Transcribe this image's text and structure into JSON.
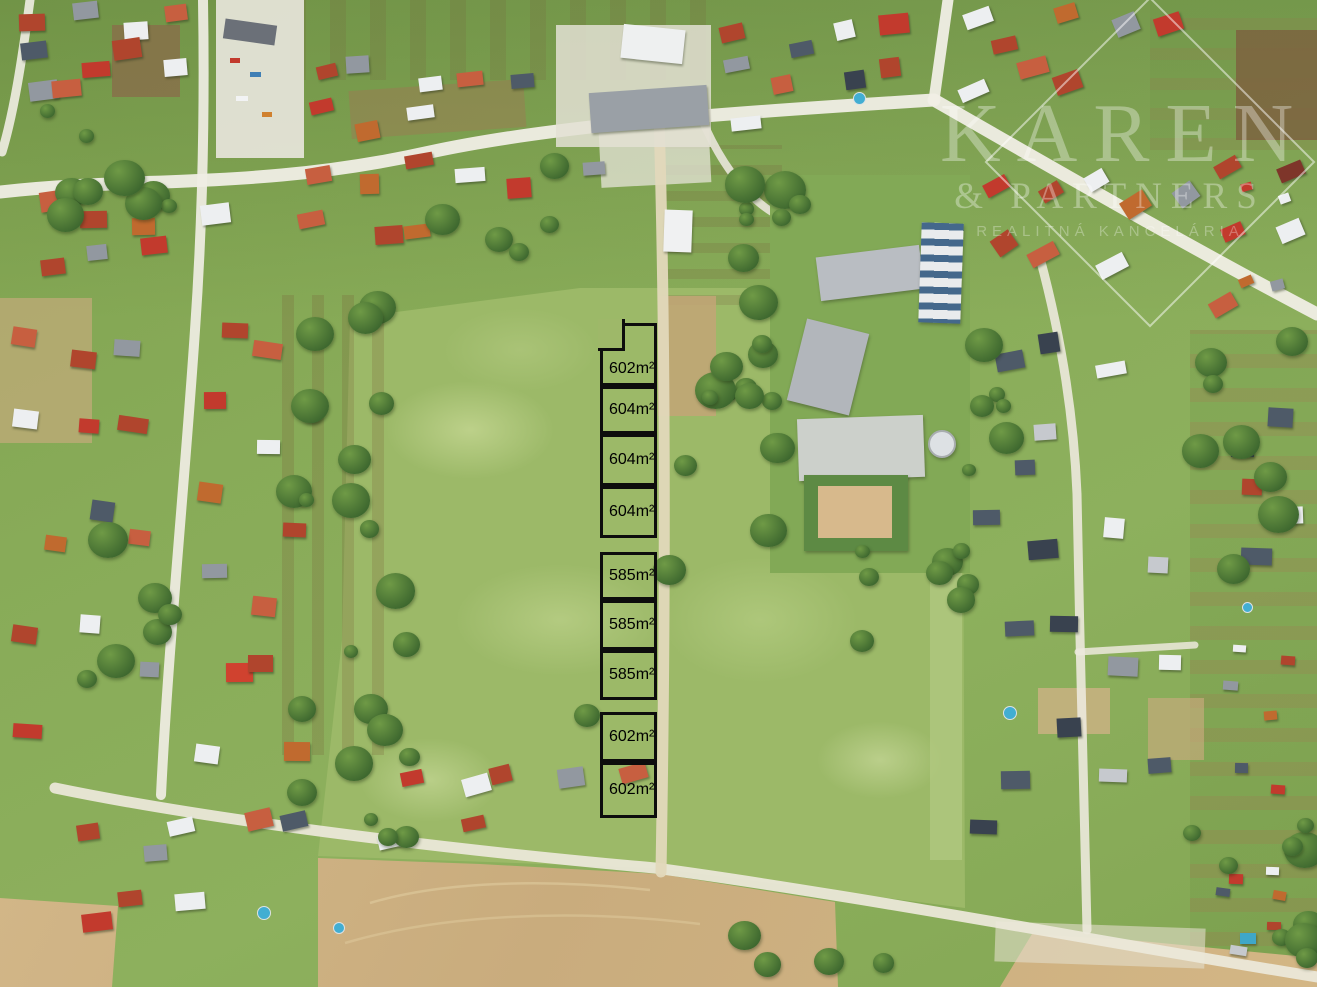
{
  "image": {
    "kind": "aerial-drone-photo",
    "width": 1317,
    "height": 987
  },
  "watermark": {
    "brand": "KAREN",
    "partners": "& PARTNERS",
    "tagline": "REALITNÁ KANCELÁRIA",
    "color": "#ffffff"
  },
  "plot_column": {
    "x": 600,
    "width": 57,
    "outline_color": "#0d0d0d",
    "label_color": "#000000",
    "plots": [
      {
        "label": "602m²",
        "top": 323,
        "height": 63,
        "notch": true
      },
      {
        "label": "604m²",
        "top": 386,
        "height": 48
      },
      {
        "label": "604m²",
        "top": 434,
        "height": 52
      },
      {
        "label": "604m²",
        "top": 486,
        "height": 52
      },
      {
        "label": "585m²",
        "top": 552,
        "height": 48
      },
      {
        "label": "585m²",
        "top": 600,
        "height": 50
      },
      {
        "label": "585m²",
        "top": 650,
        "height": 50
      },
      {
        "label": "602m²",
        "top": 712,
        "height": 50
      },
      {
        "label": "602m²",
        "top": 762,
        "height": 56
      }
    ]
  },
  "palette": {
    "grass": "#87a956",
    "meadow": "#9cb968",
    "road": "#f0eee5",
    "dirt_path": "#e2d8ba",
    "plowed_field": "#cfb284",
    "tree": "#3e682f",
    "plot_line": "#0d0d0d",
    "roof_red": "#b0452d",
    "roof_salmon": "#c75f40",
    "roof_orange": "#c06a2f",
    "roof_bright_red": "#c23a2d",
    "roof_gray": "#9298a0",
    "roof_slate": "#4e5a68",
    "roof_dark_slate": "#39424f",
    "roof_white": "#edeff1"
  },
  "scene": {
    "house_clusters": [
      {
        "name": "top-edge-left",
        "x": 5,
        "y": 2,
        "w": 210,
        "h": 118,
        "n": 10,
        "rot": -6,
        "seed": 11,
        "colors": [
          "#b0452d",
          "#9298a0",
          "#edeff1",
          "#c75f40",
          "#4e5a68",
          "#c23a2d",
          "#b0452d",
          "#edeff1",
          "#9298a0",
          "#c75f40"
        ]
      },
      {
        "name": "top-left-road-south",
        "x": 35,
        "y": 192,
        "w": 200,
        "h": 85,
        "n": 7,
        "rot": -4,
        "seed": 12,
        "colors": [
          "#c75f40",
          "#b0452d",
          "#c06a2f",
          "#edeff1",
          "#b0452d",
          "#9298a0",
          "#c23a2d"
        ]
      },
      {
        "name": "top-mid-north",
        "x": 300,
        "y": 55,
        "w": 250,
        "h": 85,
        "n": 8,
        "rot": -8,
        "seed": 13,
        "colors": [
          "#b0452d",
          "#9298a0",
          "#edeff1",
          "#c75f40",
          "#4e5a68",
          "#c23a2d",
          "#c06a2f",
          "#edeff1"
        ]
      },
      {
        "name": "top-mid-south",
        "x": 295,
        "y": 150,
        "w": 310,
        "h": 110,
        "n": 9,
        "rot": -6,
        "seed": 14,
        "colors": [
          "#c75f40",
          "#c06a2f",
          "#b0452d",
          "#edeff1",
          "#c23a2d",
          "#9298a0",
          "#c75f40",
          "#b0452d",
          "#c06a2f"
        ]
      },
      {
        "name": "top-center",
        "x": 715,
        "y": 15,
        "w": 215,
        "h": 125,
        "n": 9,
        "rot": -10,
        "seed": 15,
        "colors": [
          "#b0452d",
          "#4e5a68",
          "#edeff1",
          "#c23a2d",
          "#9298a0",
          "#c75f40",
          "#39424f",
          "#b0452d",
          "#edeff1"
        ]
      },
      {
        "name": "junction-east",
        "x": 950,
        "y": 5,
        "w": 235,
        "h": 100,
        "n": 8,
        "rot": -18,
        "seed": 16,
        "colors": [
          "#edeff1",
          "#b0452d",
          "#c06a2f",
          "#9298a0",
          "#c23a2d",
          "#edeff1",
          "#c75f40",
          "#b0452d"
        ]
      },
      {
        "name": "right-edge-top",
        "x": 1190,
        "y": 150,
        "w": 120,
        "h": 180,
        "n": 5,
        "rot": -25,
        "seed": 17,
        "colors": [
          "#b0452d",
          "#7e352a",
          "#c23a2d",
          "#edeff1",
          "#c75f40"
        ]
      },
      {
        "name": "diagonal-road-south",
        "x": 975,
        "y": 140,
        "w": 250,
        "h": 160,
        "n": 8,
        "rot": -32,
        "seed": 18,
        "colors": [
          "#c23a2d",
          "#b0452d",
          "#edeff1",
          "#c06a2f",
          "#9298a0",
          "#b0452d",
          "#c75f40",
          "#edeff1"
        ]
      },
      {
        "name": "left-street-west",
        "x": 15,
        "y": 300,
        "w": 150,
        "h": 490,
        "n": 13,
        "rot": 3,
        "seed": 19,
        "colors": [
          "#c75f40",
          "#b0452d",
          "#9298a0",
          "#edeff1",
          "#c23a2d",
          "#b0452d",
          "#c06a2f",
          "#4e5a68",
          "#c75f40",
          "#b0452d",
          "#edeff1",
          "#9298a0",
          "#c23a2d"
        ]
      },
      {
        "name": "left-street-east",
        "x": 198,
        "y": 295,
        "w": 108,
        "h": 500,
        "n": 12,
        "rot": 3,
        "seed": 20,
        "colors": [
          "#b0452d",
          "#c75f40",
          "#c23a2d",
          "#edeff1",
          "#c06a2f",
          "#b0452d",
          "#9298a0",
          "#c75f40",
          "#d0422f",
          "#b0452d",
          "#edeff1",
          "#c06a2f"
        ]
      },
      {
        "name": "left-bottom",
        "x": 65,
        "y": 798,
        "w": 255,
        "h": 145,
        "n": 8,
        "rot": -8,
        "seed": 21,
        "colors": [
          "#b0452d",
          "#9298a0",
          "#edeff1",
          "#c75f40",
          "#4e5a68",
          "#c23a2d",
          "#b0452d",
          "#edeff1"
        ]
      },
      {
        "name": "bottom-mid-row",
        "x": 380,
        "y": 762,
        "w": 270,
        "h": 100,
        "n": 7,
        "rot": -10,
        "seed": 22,
        "colors": [
          "#c23a2d",
          "#edeff1",
          "#b0452d",
          "#9298a0",
          "#c75f40",
          "#edeff1",
          "#b0452d"
        ]
      },
      {
        "name": "dev-street",
        "x": 975,
        "y": 498,
        "w": 210,
        "h": 400,
        "n": 13,
        "rot": 1,
        "seed": 23,
        "colors": [
          "#4e5a68",
          "#39424f",
          "#edeff1",
          "#c6c9ce",
          "#4e5a68",
          "#39424f",
          "#9298a0",
          "#edeff1",
          "#4e5a68",
          "#39424f",
          "#c6c9ce",
          "#4e5a68",
          "#39424f"
        ]
      },
      {
        "name": "right-mid",
        "x": 1225,
        "y": 395,
        "w": 90,
        "h": 200,
        "n": 5,
        "rot": 0,
        "seed": 24,
        "colors": [
          "#39424f",
          "#4e5a68",
          "#b0452d",
          "#edeff1",
          "#4e5a68"
        ]
      },
      {
        "name": "bottom-right-sheds",
        "x": 1205,
        "y": 858,
        "w": 110,
        "h": 115,
        "n": 7,
        "rot": 5,
        "seed": 25,
        "s": 0.55,
        "colors": [
          "#c23a2d",
          "#edeff1",
          "#4e5a68",
          "#c06a2f",
          "#3fa7c8",
          "#b0452d",
          "#c6c9ce"
        ]
      },
      {
        "name": "allotment-cabins",
        "x": 1215,
        "y": 600,
        "w": 95,
        "h": 215,
        "n": 6,
        "rot": 0,
        "seed": 26,
        "s": 0.5,
        "colors": [
          "#edeff1",
          "#b0452d",
          "#9298a0",
          "#c06a2f",
          "#4e5a68",
          "#c23a2d"
        ]
      },
      {
        "name": "top-right-cabins",
        "x": 1228,
        "y": 175,
        "w": 85,
        "h": 140,
        "n": 4,
        "rot": -20,
        "seed": 27,
        "s": 0.55,
        "colors": [
          "#c23a2d",
          "#edeff1",
          "#c06a2f",
          "#9298a0"
        ]
      },
      {
        "name": "school-east-houses",
        "x": 990,
        "y": 300,
        "w": 130,
        "h": 190,
        "n": 5,
        "rot": -8,
        "seed": 28,
        "colors": [
          "#4e5a68",
          "#39424f",
          "#edeff1",
          "#4e5a68",
          "#c6c9ce"
        ]
      }
    ],
    "tree_clusters": [
      {
        "x": 20,
        "y": 85,
        "w": 160,
        "h": 150,
        "n": 10,
        "seed": 31
      },
      {
        "x": 278,
        "y": 285,
        "w": 130,
        "h": 470,
        "n": 16,
        "seed": 32
      },
      {
        "x": 678,
        "y": 235,
        "w": 115,
        "h": 195,
        "n": 11,
        "seed": 33
      },
      {
        "x": 845,
        "y": 550,
        "w": 125,
        "h": 120,
        "n": 8,
        "seed": 34
      },
      {
        "x": 295,
        "y": 730,
        "w": 150,
        "h": 125,
        "n": 7,
        "seed": 35
      },
      {
        "x": 1135,
        "y": 815,
        "w": 180,
        "h": 145,
        "n": 9,
        "seed": 36
      },
      {
        "x": 415,
        "y": 165,
        "w": 140,
        "h": 95,
        "n": 5,
        "seed": 37
      },
      {
        "x": 540,
        "y": 430,
        "w": 280,
        "h": 300,
        "n": 5,
        "seed": 38
      },
      {
        "x": 952,
        "y": 295,
        "w": 60,
        "h": 185,
        "n": 6,
        "seed": 39
      },
      {
        "x": 1190,
        "y": 335,
        "w": 125,
        "h": 310,
        "n": 8,
        "seed": 40
      },
      {
        "x": 55,
        "y": 530,
        "w": 120,
        "h": 210,
        "n": 6,
        "seed": 41
      },
      {
        "x": 690,
        "y": 895,
        "w": 310,
        "h": 80,
        "n": 4,
        "seed": 42
      },
      {
        "x": 735,
        "y": 150,
        "w": 180,
        "h": 80,
        "n": 6,
        "seed": 43
      }
    ],
    "dirt_patches": [
      {
        "x": 112,
        "y": 25,
        "w": 68,
        "h": 72,
        "c": "#8a6b4a",
        "o": 0.75,
        "r": 0
      },
      {
        "x": 350,
        "y": 85,
        "w": 175,
        "h": 48,
        "c": "#9b7a52",
        "o": 0.5,
        "r": -4
      },
      {
        "x": 658,
        "y": 296,
        "w": 58,
        "h": 120,
        "c": "#c3a477",
        "o": 0.85,
        "r": 0
      },
      {
        "x": 0,
        "y": 298,
        "w": 92,
        "h": 145,
        "c": "#c9ab7e",
        "o": 0.65,
        "r": 0
      },
      {
        "x": 1236,
        "y": 30,
        "w": 81,
        "h": 110,
        "c": "#7d5f3e",
        "o": 0.8,
        "r": 0
      },
      {
        "x": 1038,
        "y": 688,
        "w": 72,
        "h": 46,
        "c": "#cdb185",
        "o": 0.8,
        "r": 0
      },
      {
        "x": 1148,
        "y": 698,
        "w": 56,
        "h": 62,
        "c": "#c9ab7e",
        "o": 0.65,
        "r": 0
      },
      {
        "x": 930,
        "y": 300,
        "w": 32,
        "h": 560,
        "c": "#b3ca83",
        "o": 0.7,
        "r": 0
      },
      {
        "x": 600,
        "y": 130,
        "w": 110,
        "h": 55,
        "c": "#e7e4d9",
        "o": 0.75,
        "r": -3
      },
      {
        "x": 995,
        "y": 925,
        "w": 210,
        "h": 40,
        "c": "#e3ddcb",
        "o": 0.6,
        "r": 2
      }
    ],
    "pools": [
      {
        "x": 263,
        "y": 912,
        "d": 12
      },
      {
        "x": 338,
        "y": 927,
        "d": 10
      },
      {
        "x": 858,
        "y": 97,
        "d": 11
      },
      {
        "x": 1009,
        "y": 712,
        "d": 12
      },
      {
        "x": 1246,
        "y": 606,
        "d": 9
      }
    ]
  }
}
